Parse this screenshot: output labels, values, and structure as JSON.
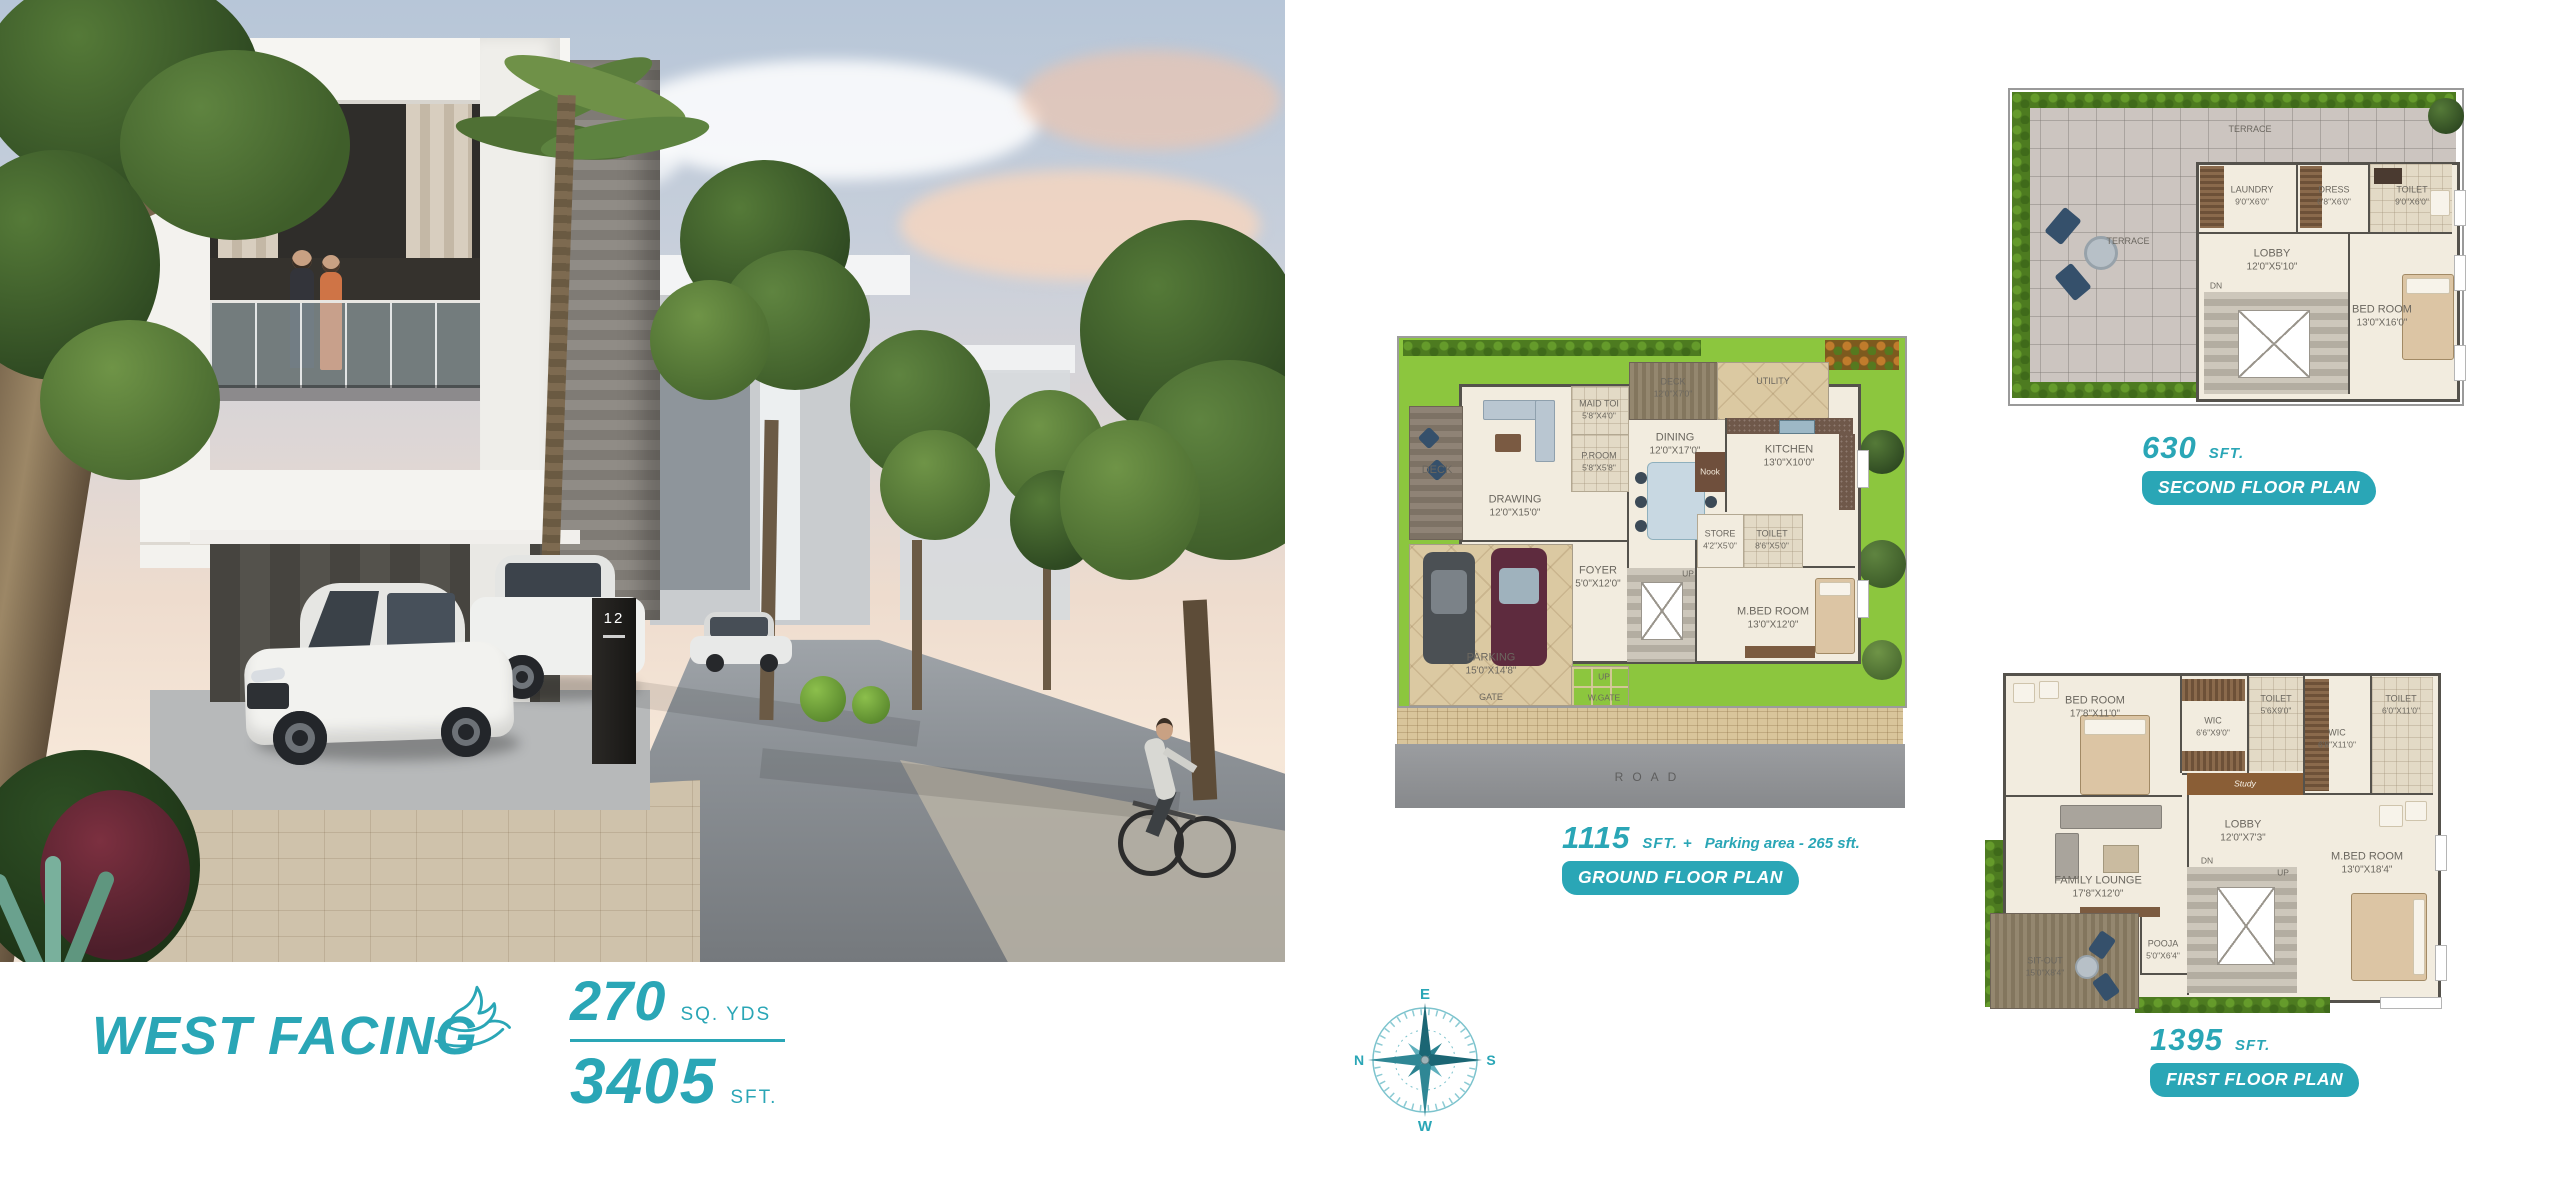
{
  "colors": {
    "accent": "#2aa6b6"
  },
  "hero": {
    "title": "WEST FACING",
    "sq_yds_value": "270",
    "sq_yds_unit": "SQ. YDS",
    "sft_value": "3405",
    "sft_unit": "SFT."
  },
  "photo": {
    "house_number": "12"
  },
  "compass": {
    "north": "N",
    "east": "E",
    "south": "S",
    "west": "W"
  },
  "plans": {
    "ground": {
      "area_value": "1115",
      "area_unit": "SFT. +",
      "area_extra": "Parking area - 265 sft.",
      "badge": "GROUND FLOOR PLAN",
      "rooms": {
        "deck_side": {
          "name": "DECK",
          "dims": ""
        },
        "deck_top": {
          "name": "DECK",
          "dims": "12'0\"X7'0\""
        },
        "utility": {
          "name": "UTILITY",
          "dims": ""
        },
        "drawing": {
          "name": "DRAWING",
          "dims": "12'0\"X15'0\""
        },
        "maid_toi": {
          "name": "MAID TOI",
          "dims": "5'8\"X4'0\""
        },
        "p_room": {
          "name": "P.ROOM",
          "dims": "5'8\"X5'8\""
        },
        "dining": {
          "name": "DINING",
          "dims": "12'0\"X17'0\""
        },
        "kitchen": {
          "name": "KITCHEN",
          "dims": "13'0\"X10'0\""
        },
        "nook": {
          "name": "Nook",
          "dims": ""
        },
        "store": {
          "name": "STORE",
          "dims": "4'2\"X5'0\""
        },
        "toilet": {
          "name": "TOILET",
          "dims": "8'6\"X5'0\""
        },
        "m_bed": {
          "name": "M.BED ROOM",
          "dims": "13'0\"X12'0\""
        },
        "foyer": {
          "name": "FOYER",
          "dims": "5'0\"X12'0\""
        },
        "parking": {
          "name": "PARKING",
          "dims": "15'0\"X14'8\""
        },
        "gate": {
          "name": "GATE",
          "dims": ""
        },
        "up_stairs": {
          "name": "UP",
          "dims": ""
        },
        "up_gate": {
          "name": "UP",
          "dims": ""
        },
        "w_gate": {
          "name": "W.GATE",
          "dims": ""
        },
        "road": {
          "name": "ROAD",
          "dims": ""
        }
      }
    },
    "first": {
      "area_value": "1395",
      "area_unit": "SFT.",
      "badge": "FIRST FLOOR PLAN",
      "rooms": {
        "bed_room": {
          "name": "BED ROOM",
          "dims": "17'8\"X11'0\""
        },
        "wic_a": {
          "name": "WIC",
          "dims": "6'6\"X9'0\""
        },
        "toilet_a": {
          "name": "TOILET",
          "dims": "5'6X9'0\""
        },
        "wic_b": {
          "name": "WIC",
          "dims": "6'8\"X11'0\""
        },
        "toilet_b": {
          "name": "TOILET",
          "dims": "6'0\"X11'0\""
        },
        "study": {
          "name": "Study",
          "dims": ""
        },
        "lobby": {
          "name": "LOBBY",
          "dims": "12'0\"X7'3\""
        },
        "dn": {
          "name": "DN",
          "dims": ""
        },
        "up": {
          "name": "UP",
          "dims": ""
        },
        "m_bed": {
          "name": "M.BED ROOM",
          "dims": "13'0\"X18'4\""
        },
        "family_lounge": {
          "name": "FAMILY LOUNGE",
          "dims": "17'8\"X12'0\""
        },
        "pooja": {
          "name": "POOJA",
          "dims": "5'0\"X6'4\""
        },
        "sit_out": {
          "name": "SIT-OUT",
          "dims": "15'0\"X8'4\""
        }
      }
    },
    "second": {
      "area_value": "630",
      "area_unit": "SFT.",
      "badge": "SECOND FLOOR PLAN",
      "rooms": {
        "terrace_top": {
          "name": "TERRACE",
          "dims": ""
        },
        "terrace_side": {
          "name": "TERRACE",
          "dims": ""
        },
        "laundry": {
          "name": "LAUNDRY",
          "dims": "9'0\"X6'0\""
        },
        "dress": {
          "name": "DRESS",
          "dims": "6'8\"X6'0\""
        },
        "toilet": {
          "name": "TOILET",
          "dims": "9'0\"X6'0\""
        },
        "lobby": {
          "name": "LOBBY",
          "dims": "12'0\"X5'10\""
        },
        "dn": {
          "name": "DN",
          "dims": ""
        },
        "bed_room": {
          "name": "BED ROOM",
          "dims": "13'0\"X16'0\""
        }
      }
    }
  }
}
